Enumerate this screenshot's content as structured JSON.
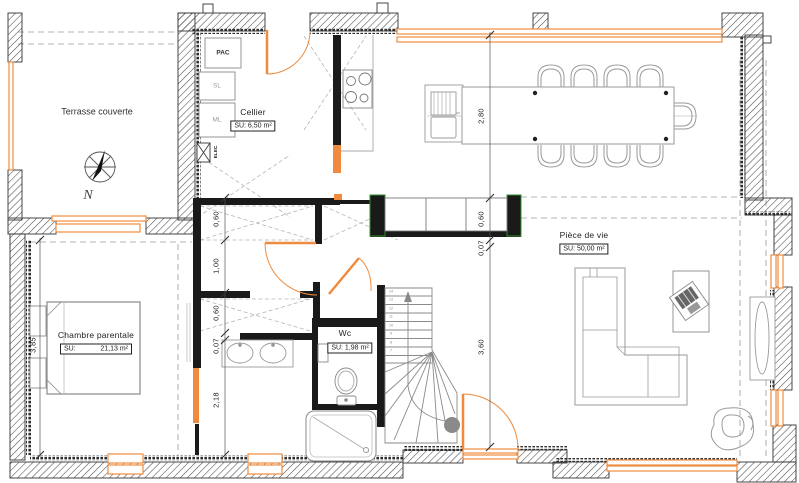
{
  "rooms": {
    "terrace": {
      "name": "Terrasse couverte"
    },
    "cellier": {
      "name": "Cellier",
      "su": "SU: 6,50 m²"
    },
    "wc": {
      "name": "Wc",
      "su": "SU: 1,98 m²"
    },
    "living": {
      "name": "Pièce de vie",
      "su": "SU: 50,00 m²"
    },
    "bedroom": {
      "name": "Chambre parentale",
      "su_prefix": "SU:",
      "su_value": "21,13 m²"
    }
  },
  "appliances": {
    "pac": "PAC",
    "sl": "SL",
    "ml": "ML",
    "elec": "ELEC"
  },
  "compass": {
    "north": "N"
  },
  "dimensions": {
    "left_chain": {
      "d1": "0,60",
      "d2": "1,00",
      "d3": "0,60",
      "d4": "0,07",
      "d5": "2,18"
    },
    "right_chain": {
      "d1": "2,80",
      "d2": "0,60",
      "d3": "0,07",
      "d4": "3,60"
    },
    "bedroom_width": "3,85"
  },
  "stairs": {
    "treads": [
      "14",
      "13",
      "12",
      "11",
      "10",
      "9",
      "8",
      "7"
    ]
  },
  "colors": {
    "accent_orange": "#ef8b3e",
    "marker_green": "#2e8f2a"
  }
}
